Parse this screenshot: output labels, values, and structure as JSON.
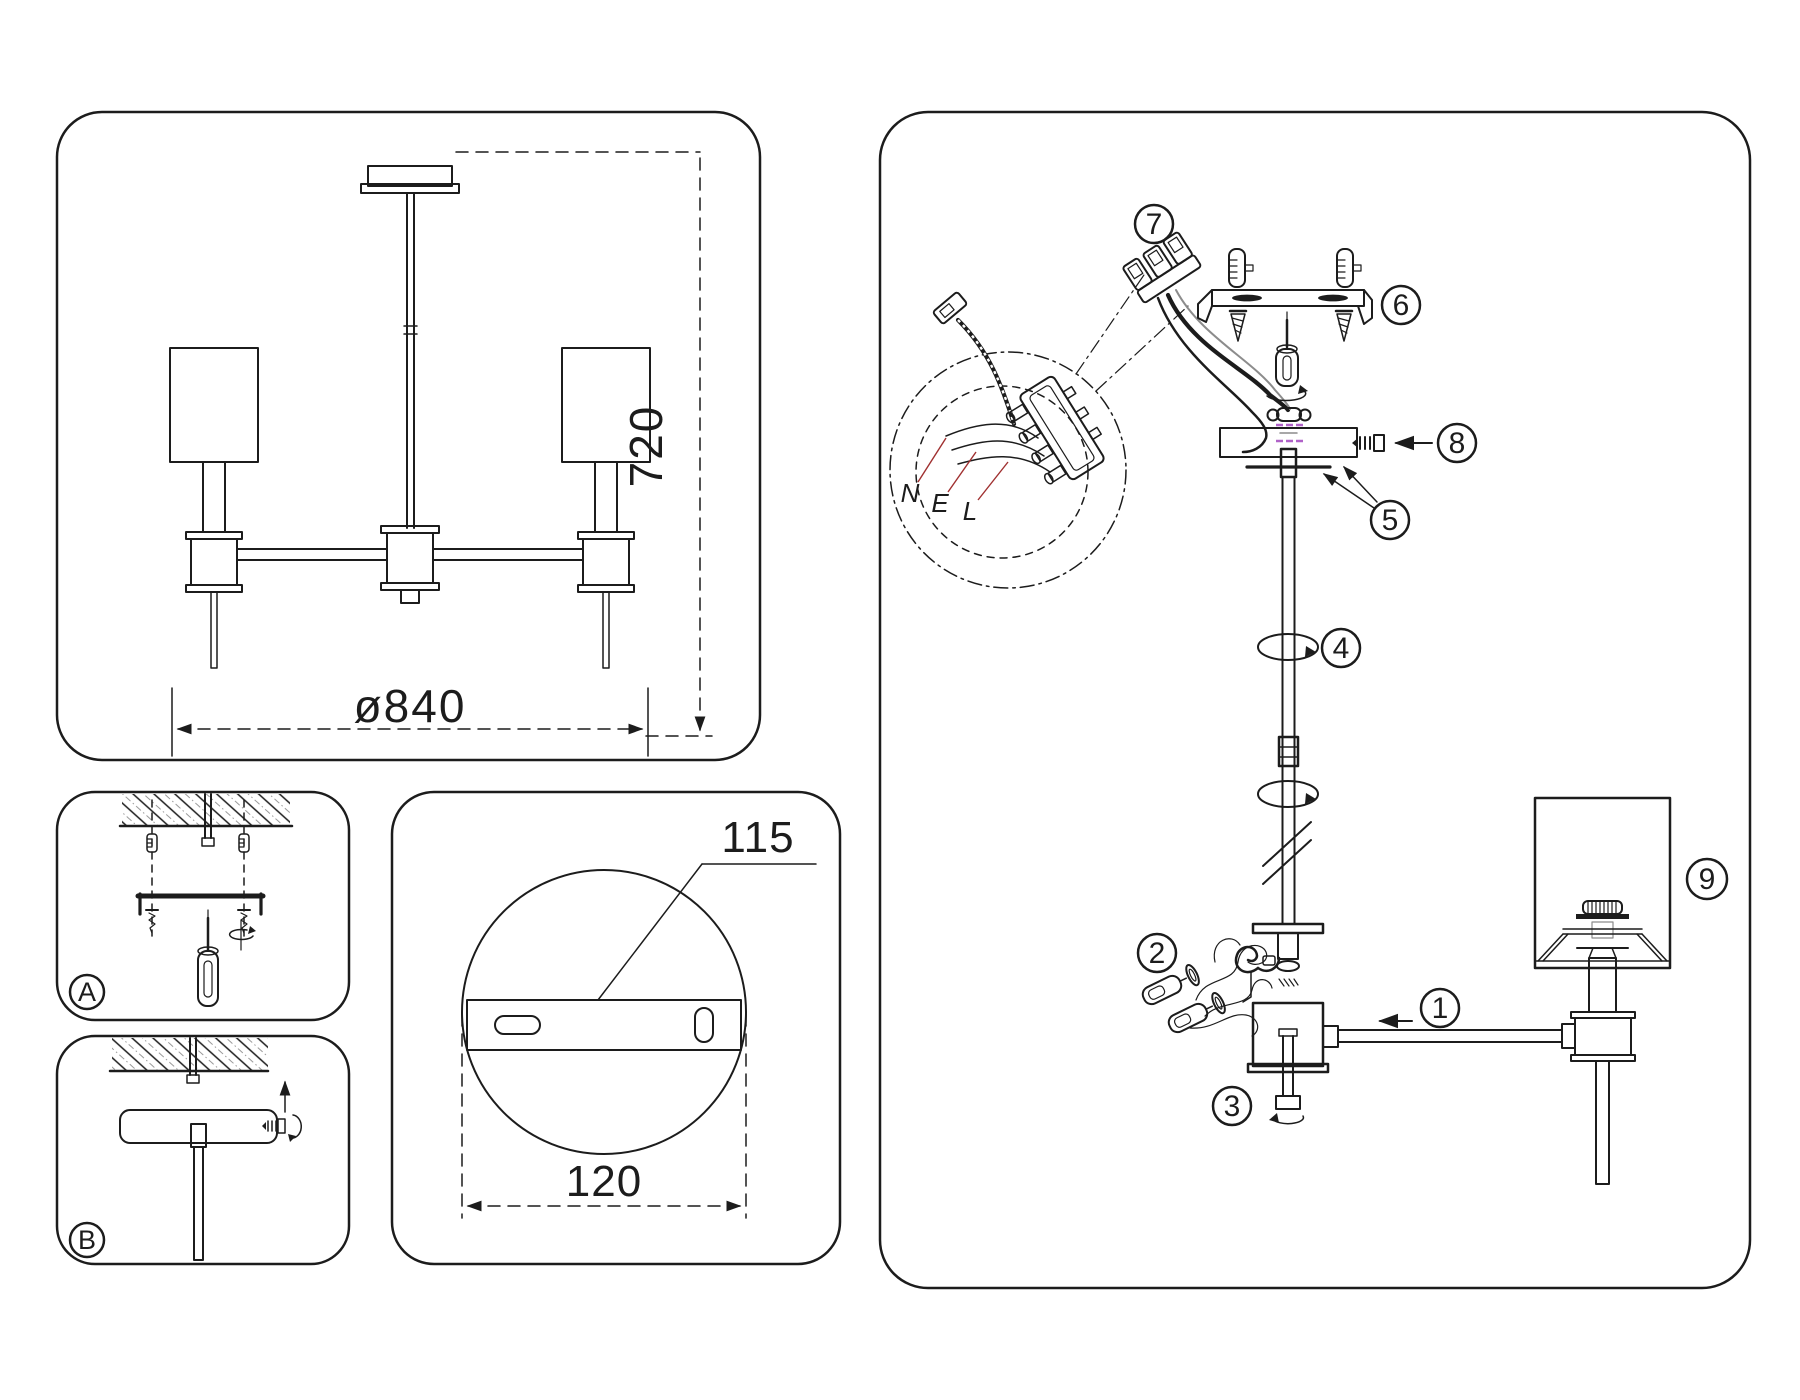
{
  "panels": {
    "overview": {
      "height_dim": "720",
      "diameter_dim": "ø840"
    },
    "mount_plate": {
      "bracket_dim": "115",
      "plate_dim": "120"
    },
    "step_a": {
      "label": "A"
    },
    "step_b": {
      "label": "B"
    }
  },
  "wiring": {
    "neutral": "N",
    "earth": "E",
    "live": "L"
  },
  "callouts": [
    "1",
    "2",
    "3",
    "4",
    "5",
    "6",
    "7",
    "8",
    "9"
  ],
  "colors": {
    "line": "#1c1c1c",
    "thread_accent": "#b062c8",
    "wire_leader_red": "#a03030",
    "hatch_gray": "#9a9a9a"
  }
}
